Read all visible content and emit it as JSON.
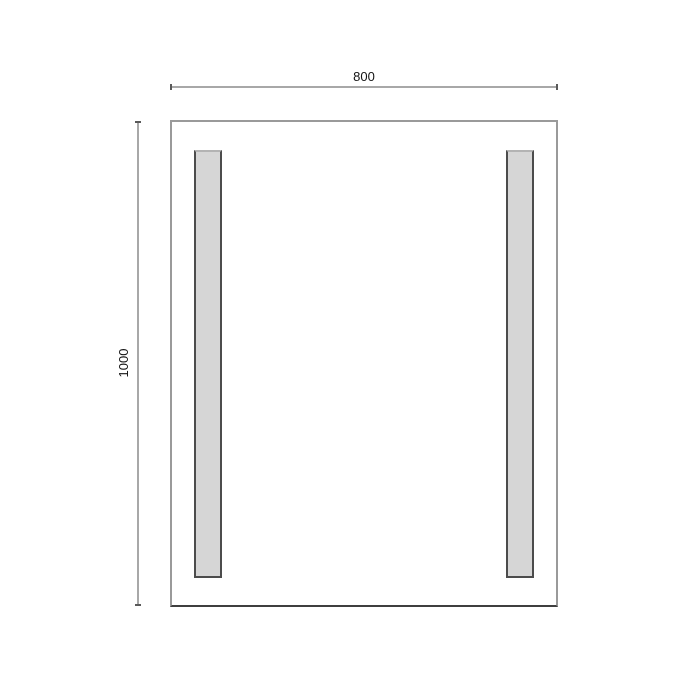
{
  "diagram": {
    "type": "technical-dimension-drawing",
    "subject": "rectangular mirror / panel front view with two vertical light strips",
    "dimensions": {
      "width_label": "800",
      "height_label": "1000"
    },
    "shapes": {
      "outer_rectangle": {
        "width_units": 800,
        "height_units": 1000,
        "outline_color": "#9a9a9a",
        "bottom_edge_color": "#3f3f3f",
        "fill": "#ffffff"
      },
      "strips": {
        "count": 2,
        "orientation": "vertical",
        "fill": "#d6d6d6",
        "border_color": "#4c4c4c"
      },
      "dimension_lines": {
        "color": "#a8a8a8",
        "tick_color": "#5a5a5a"
      }
    },
    "colors": {
      "background": "#ffffff",
      "text": "#141414"
    }
  }
}
